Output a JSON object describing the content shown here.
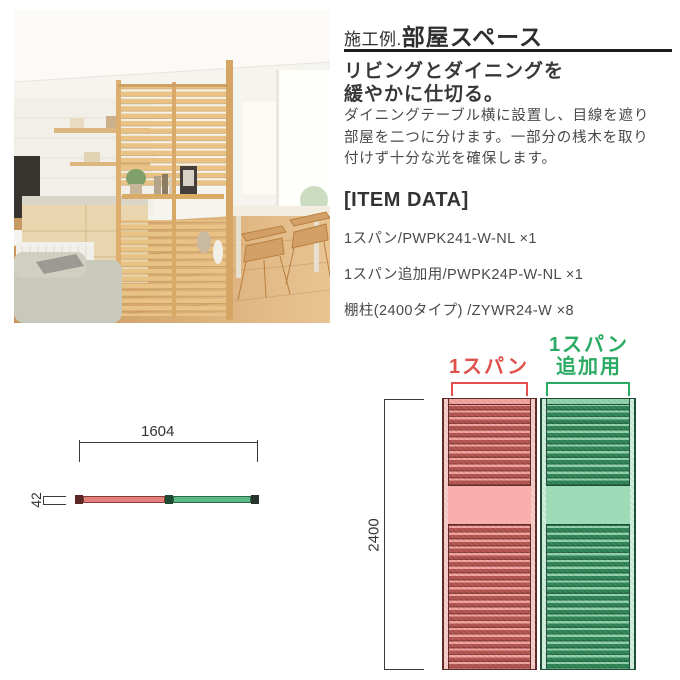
{
  "header": {
    "title_prefix": "施工例.",
    "title_main": "部屋スペース"
  },
  "intro": {
    "subtitle_line1": "リビングとダイニングを",
    "subtitle_line2": "緩やかに仕切る。",
    "body_line1": "ダイニングテーブル横に設置し、目線を遮り",
    "body_line2": "部屋を二つに分けます。一部分の桟木を取り",
    "body_line3": "付けず十分な光を確保します。"
  },
  "item_data": {
    "heading": "[ITEM DATA]",
    "items": [
      "1スパン/PWPK241-W-NL ×1",
      "1スパン追加用/PWPK24P-W-NL ×1",
      "棚柱(2400タイプ) /ZYWR24-W ×8"
    ]
  },
  "top_view_diagram": {
    "width_label": "1604",
    "depth_label": "42"
  },
  "front_view_diagram": {
    "height_label": "2400",
    "span1_label": "1スパン",
    "span2_label_line1": "1スパン",
    "span2_label_line2": "追加用",
    "colors": {
      "span1_accent": "#e0514e",
      "span2_accent": "#2baa63",
      "dimension_line": "#3a3a3a"
    }
  }
}
